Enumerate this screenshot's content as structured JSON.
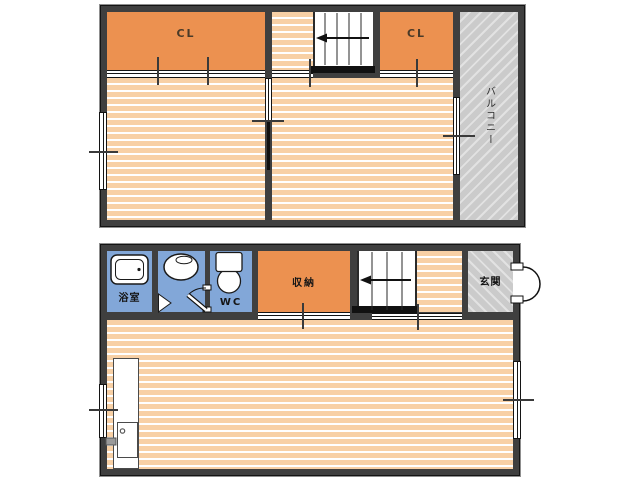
{
  "labels": {
    "upper_closet_left": "CL",
    "upper_closet_right": "CL",
    "balcony": "バルコニー",
    "bathroom": "浴室",
    "wc": "WC",
    "storage": "収納",
    "entrance": "玄関"
  },
  "colors": {
    "wall": "#3f3f3f",
    "floor_base": "#f8d0a5",
    "floor_stripe": "#ffffff",
    "closet": "#ec9150",
    "wet_area": "#82a7d8",
    "hatch_base": "#cbcbcb",
    "hatch_stripe": "#e2e2e2",
    "label_text": "#161616"
  }
}
